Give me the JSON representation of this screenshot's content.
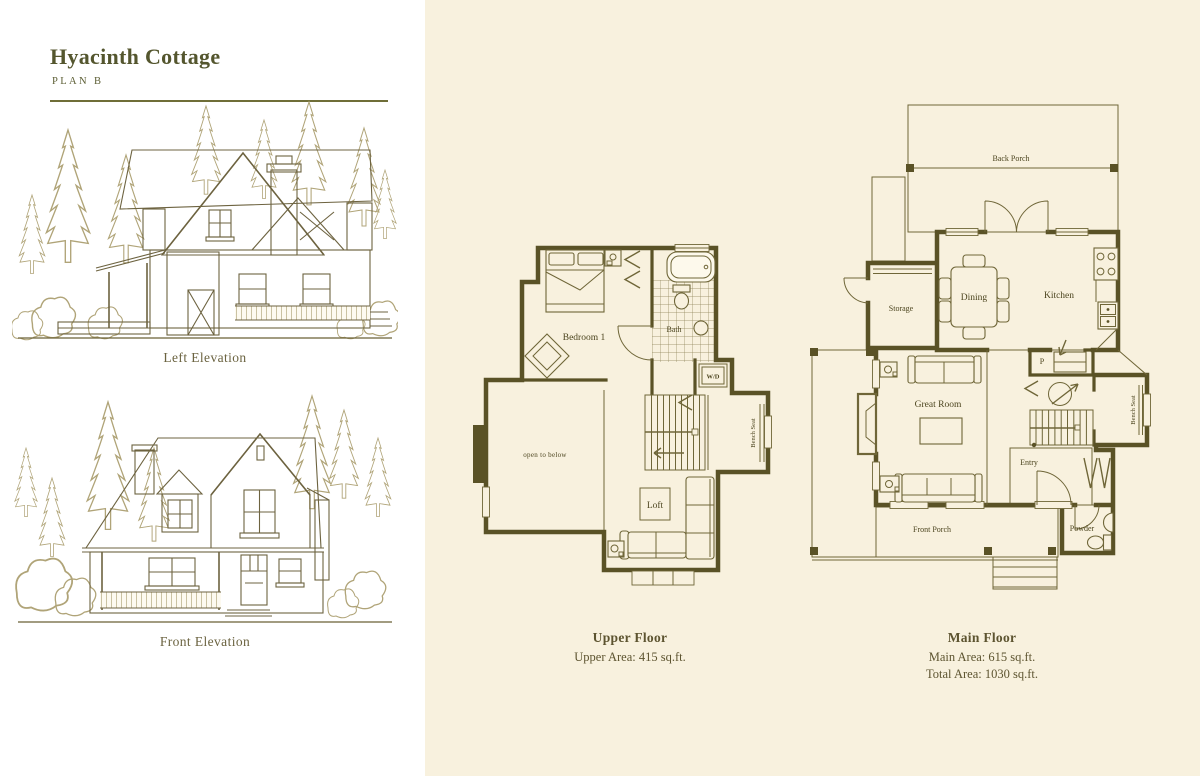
{
  "page": {
    "title": "Hyacinth Cottage",
    "subtitle": "PLAN B"
  },
  "colors": {
    "paper": "#ffffff",
    "cream": "#f8f1de",
    "wall_ink": "#5a5226",
    "title_ink": "#54562e",
    "rule": "#6f6e38",
    "tree": "#b0a478"
  },
  "elevations": {
    "left_label": "Left Elevation",
    "front_label": "Front Elevation"
  },
  "upper_floor": {
    "title": "Upper Floor",
    "area": "Upper Area: 415 sq.ft.",
    "rooms": {
      "bedroom": "Bedroom 1",
      "bath": "Bath",
      "wd": "W/D",
      "open_to_below": "open to below",
      "bench_seat": "Bench Seat",
      "loft": "Loft"
    }
  },
  "main_floor": {
    "title": "Main Floor",
    "area_main": "Main Area: 615 sq.ft.",
    "area_total": "Total Area: 1030 sq.ft.",
    "rooms": {
      "back_porch": "Back Porch",
      "storage": "Storage",
      "dining": "Dining",
      "kitchen": "Kitchen",
      "pantry": "P",
      "great_room": "Great Room",
      "entry": "Entry",
      "bench_seat": "Bench Seat",
      "front_porch": "Front Porch",
      "powder": "Powder"
    }
  }
}
